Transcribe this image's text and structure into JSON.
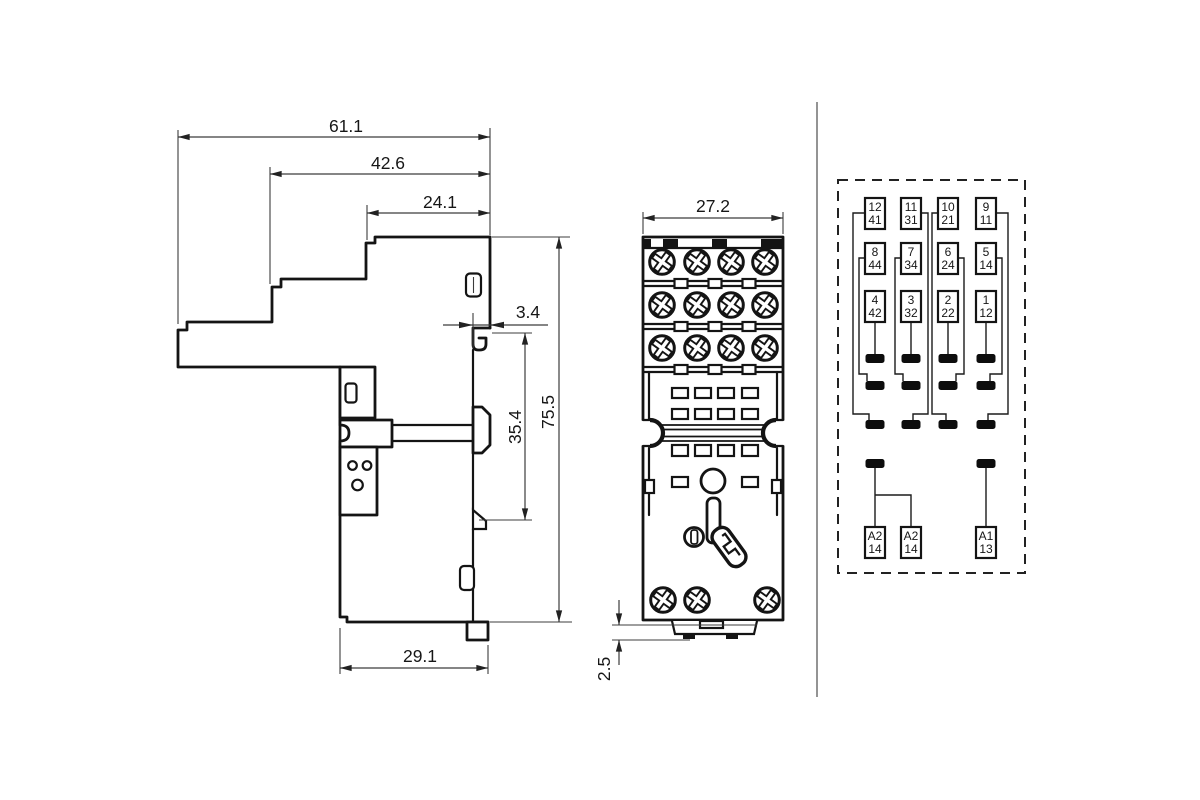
{
  "drawing": {
    "title": "relay-socket-dimensional-drawing",
    "colors": {
      "line": "#141414",
      "dim": "#3c3c3c",
      "background": "#ffffff"
    },
    "side_view": {
      "dims": {
        "total_width": "61.1",
        "upper_width": "42.6",
        "top_width": "24.1",
        "claw_gap": "3.4",
        "rail_height": "35.4",
        "total_height": "75.5",
        "bottom_width": "29.1"
      }
    },
    "front_view": {
      "dims": {
        "width": "27.2",
        "foot_height": "2.5"
      }
    },
    "schematic": {
      "rows": [
        [
          [
            "12",
            "41"
          ],
          [
            "11",
            "31"
          ],
          [
            "10",
            "21"
          ],
          [
            "9",
            "11"
          ]
        ],
        [
          [
            "8",
            "44"
          ],
          [
            "7",
            "34"
          ],
          [
            "6",
            "24"
          ],
          [
            "5",
            "14"
          ]
        ],
        [
          [
            "4",
            "42"
          ],
          [
            "3",
            "32"
          ],
          [
            "2",
            "22"
          ],
          [
            "1",
            "12"
          ]
        ]
      ],
      "coil": [
        [
          "A2",
          "14"
        ],
        [
          "A2",
          "14"
        ],
        [
          "A1",
          "13"
        ]
      ]
    }
  }
}
